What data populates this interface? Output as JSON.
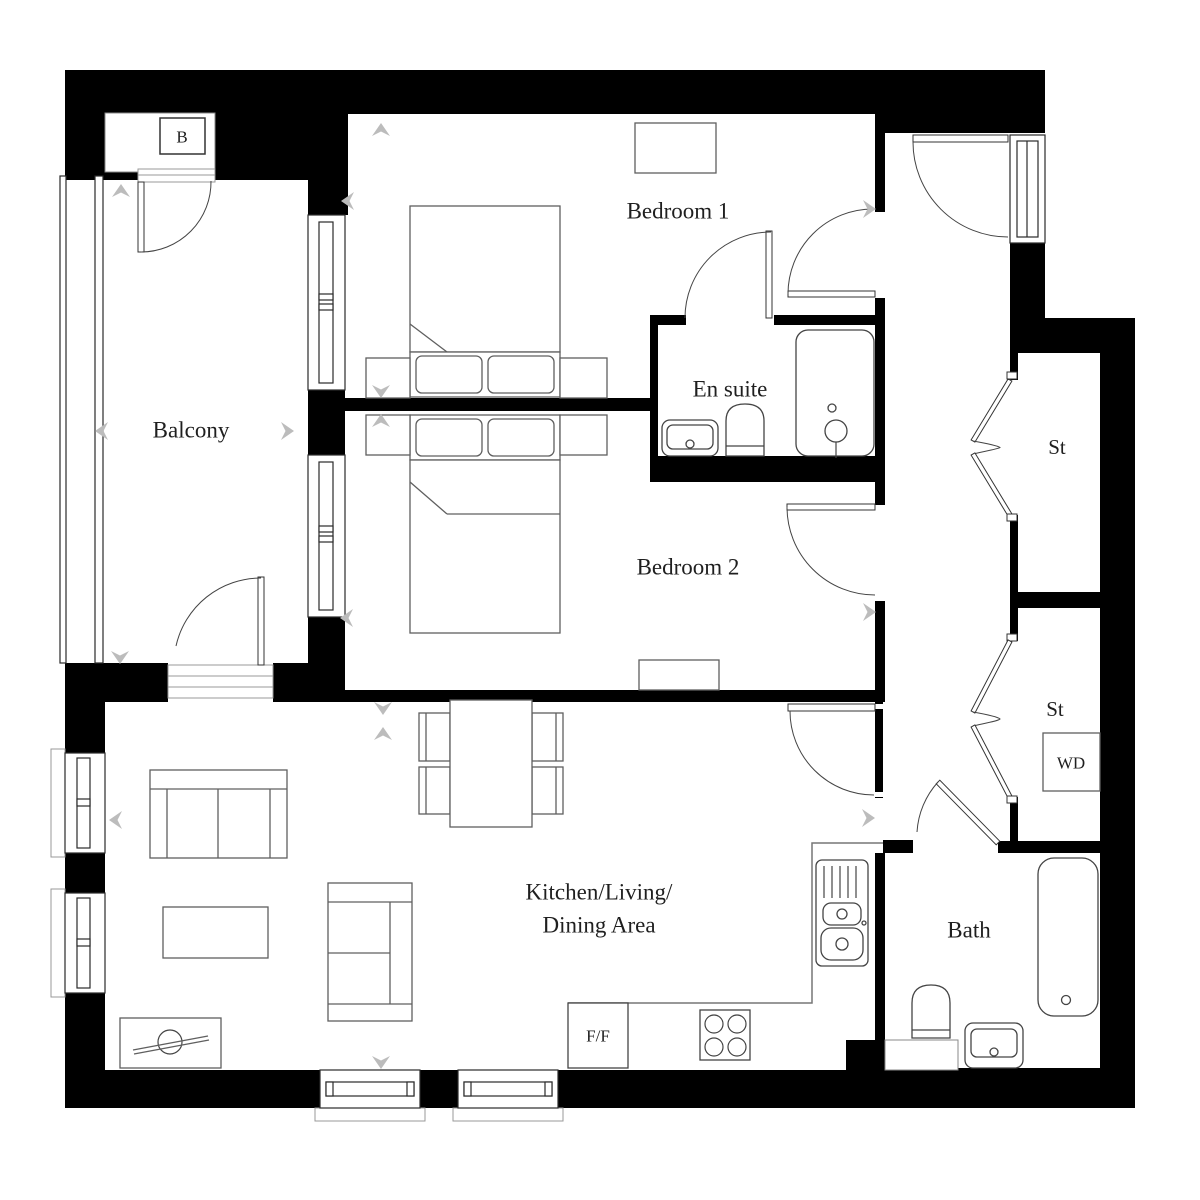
{
  "floor_plan": {
    "rooms": {
      "balcony": {
        "label": "Balcony"
      },
      "bedroom1": {
        "label": "Bedroom 1"
      },
      "ensuite": {
        "label": "En suite"
      },
      "bedroom2": {
        "label": "Bedroom 2"
      },
      "kitchen_living_dining": {
        "label_line1": "Kitchen/Living/",
        "label_line2": "Dining Area"
      },
      "bath": {
        "label": "Bath"
      },
      "storage_top": {
        "label": "St"
      },
      "storage_bottom": {
        "label": "St"
      }
    },
    "appliances": {
      "boiler": "B",
      "washer_dryer": "WD",
      "fridge_freezer": "F/F"
    },
    "colors": {
      "wall": "#000000",
      "furniture_line": "#5f5f5f",
      "arrow": "#bcbcbc",
      "text": "#1f1f1f"
    }
  }
}
